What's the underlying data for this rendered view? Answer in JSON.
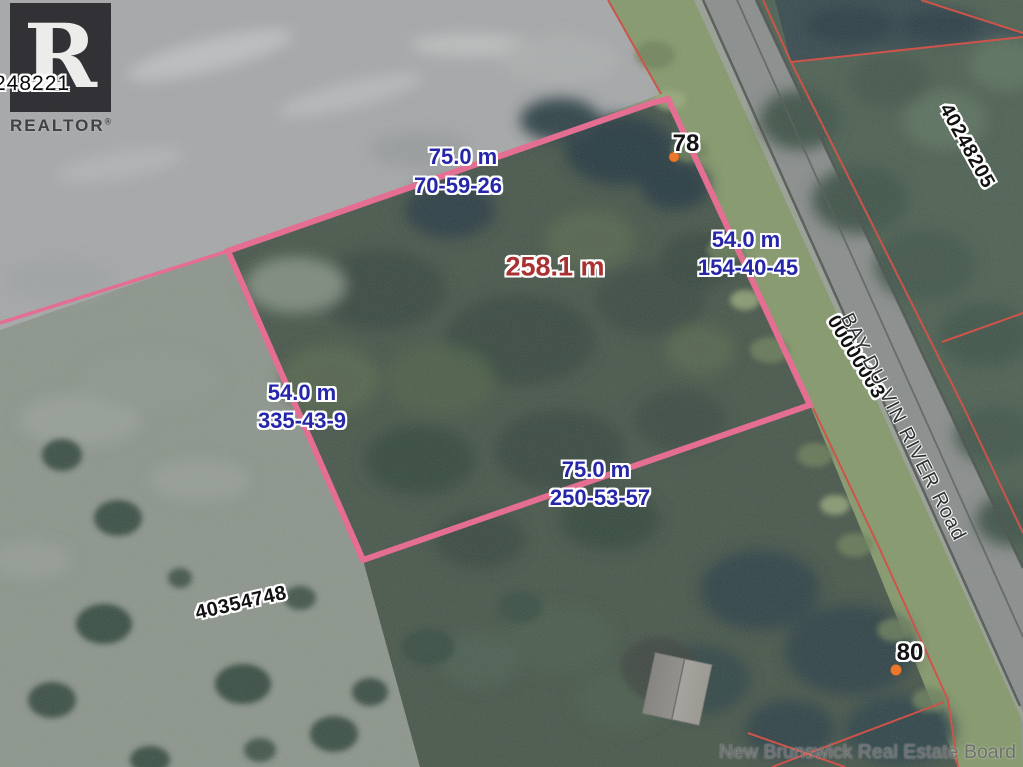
{
  "watermark": {
    "listing_id": "248221",
    "logo_letter": "R",
    "brand": "REALTOR",
    "registered_mark": "®"
  },
  "property": {
    "area_label": "258.1 m",
    "edges": [
      {
        "position": "top",
        "length": "75.0 m",
        "bearing": "70-59-26"
      },
      {
        "position": "right",
        "length": "54.0 m",
        "bearing": "154-40-45"
      },
      {
        "position": "left",
        "length": "54.0 m",
        "bearing": "335-43-9"
      },
      {
        "position": "bottom",
        "length": "75.0 m",
        "bearing": "250-53-57"
      }
    ]
  },
  "parcels": {
    "left_pid": "40354748",
    "right_pid": "40248205",
    "road_pid": "00000003"
  },
  "road": {
    "name": "BAY DU VIN RIVER Road"
  },
  "civic_numbers": {
    "north": "78",
    "south": "80"
  },
  "attribution": {
    "text": "New Brunswick Real Estate Board"
  },
  "colors": {
    "boundary_pink": "#e8688f",
    "parcel_line_red": "#cf4b41",
    "measurement_blue": "#2626a8",
    "area_red": "#a93131",
    "dot_orange": "#ee7222",
    "attribution_gray": "#707072"
  }
}
